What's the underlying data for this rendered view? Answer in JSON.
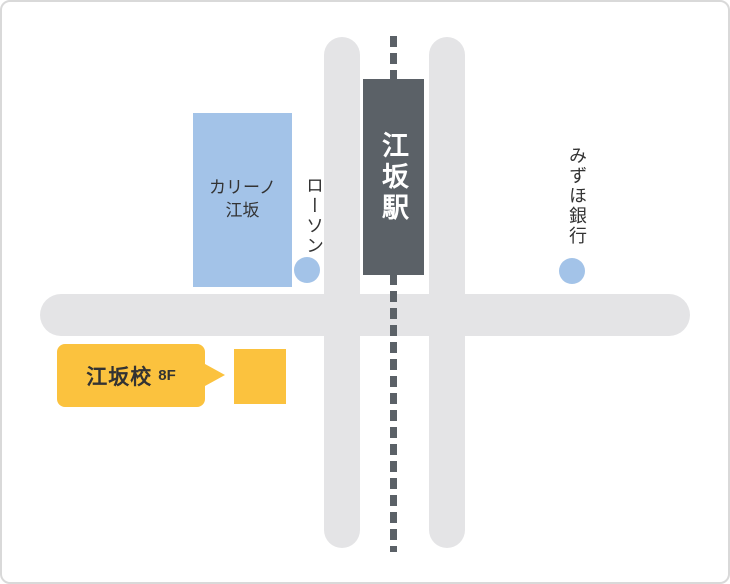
{
  "map": {
    "station": {
      "label": "江坂駅"
    },
    "landmarks": {
      "carino": {
        "label_line1": "カリーノ",
        "label_line2": "江坂"
      },
      "lawson": {
        "label": "ローソン"
      },
      "mizuho": {
        "label": "みずほ銀行"
      }
    },
    "school": {
      "name_label": "江坂校",
      "floor_label": "8F"
    },
    "colors": {
      "road_gray": "#e4e4e6",
      "rail_dark_gray": "#5b6167",
      "station_bg": "#5b6167",
      "station_text": "#ffffff",
      "landmark_blue": "#a3c3e8",
      "school_yellow": "#fbc23e",
      "label_text": "#333333",
      "card_border": "#d9d9d9"
    }
  }
}
